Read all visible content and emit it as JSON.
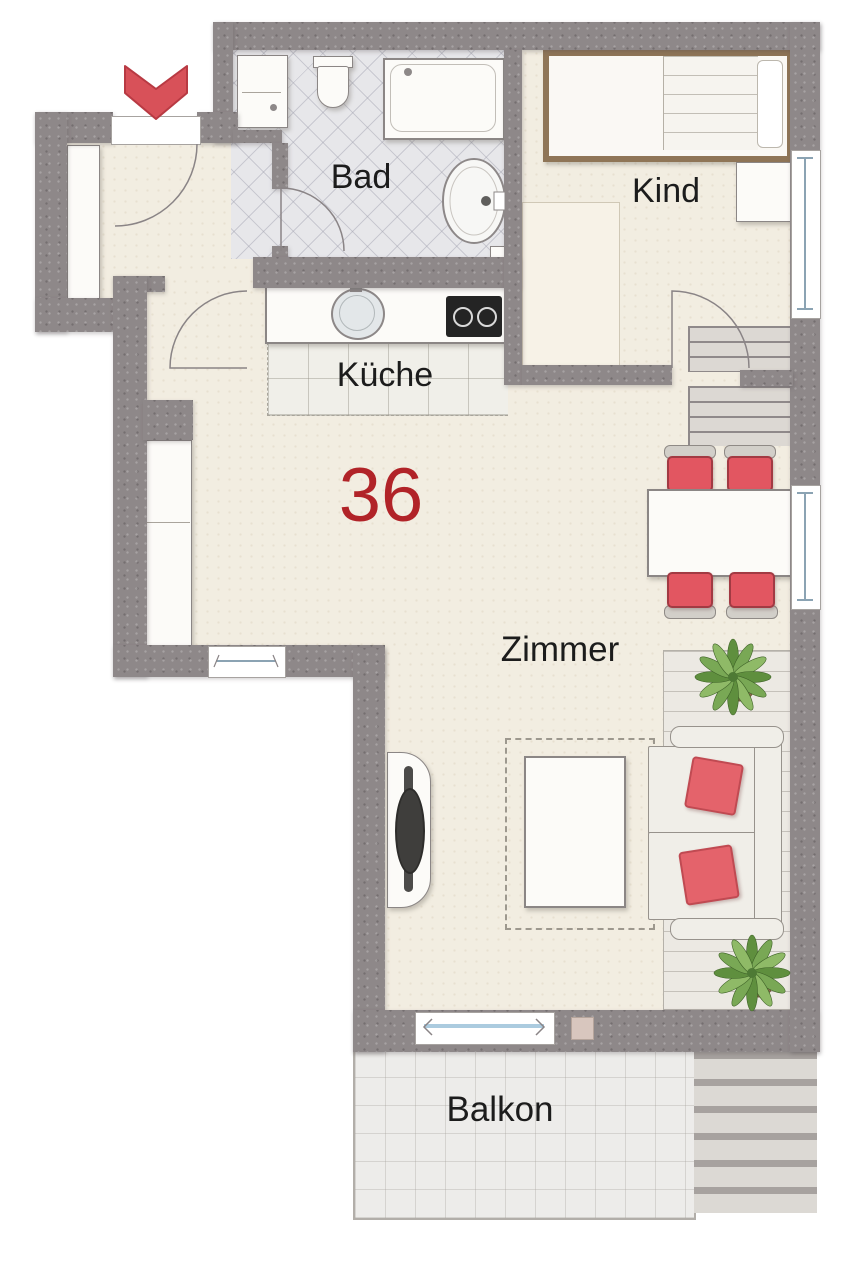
{
  "plan": {
    "unit_number": "36",
    "labels": {
      "bathroom": "Bad",
      "child_room": "Kind",
      "kitchen": "Küche",
      "living_room": "Zimmer",
      "balcony": "Balkon"
    },
    "colors": {
      "wall_gray": "#8e8889",
      "floor_cream": "#f2ede1",
      "bath_tile": "#e7e7ea",
      "chair_red": "#e25661",
      "pillow_red": "#e4636b",
      "entrance_arrow_red": "#d85159",
      "unit_number_red": "#b12328",
      "plant_green": "#6f9e4a",
      "glass_blue": "#abcbdf"
    }
  }
}
